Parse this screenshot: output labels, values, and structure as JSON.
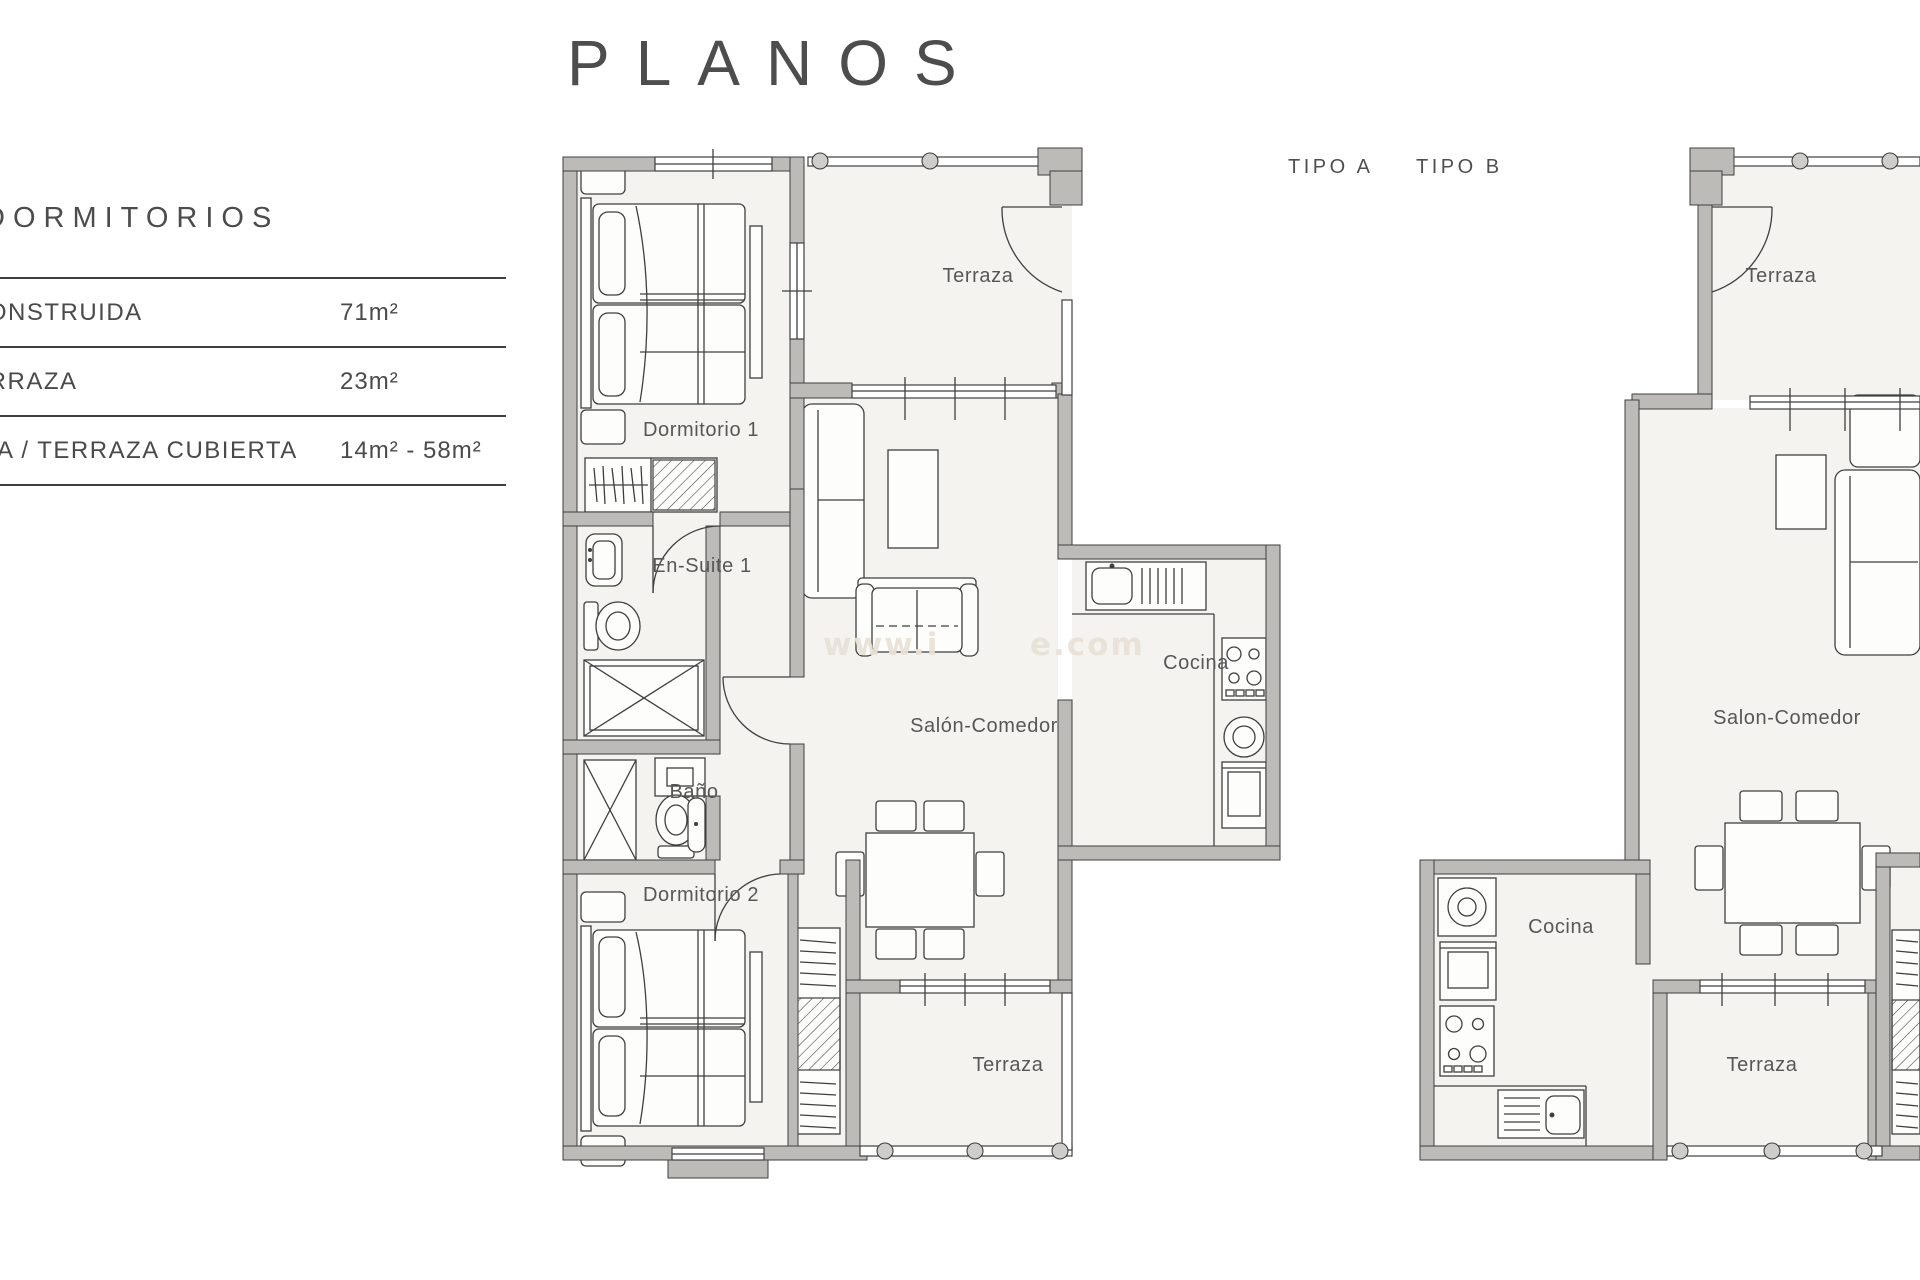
{
  "title": "PLANOS",
  "sidebar": {
    "heading": "DORMITORIOS",
    "rows": [
      {
        "label": "CONSTRUIDA",
        "value": "71m²"
      },
      {
        "label": "TERRAZA",
        "value": "23m²"
      },
      {
        "label": "A / TERRAZA CUBIERTA",
        "value": "14m² - 58m²"
      }
    ]
  },
  "plan_types": {
    "a": "TIPO A",
    "b": "TIPO B"
  },
  "plan_a": {
    "rooms": {
      "terraza_top": "Terraza",
      "dormitorio1": "Dormitorio 1",
      "ensuite": "En-Suite 1",
      "bano": "Baño",
      "dormitorio2": "Dormitorio 2",
      "salon": "Salón-Comedor",
      "cocina": "Cocina",
      "terraza_bottom": "Terraza"
    }
  },
  "plan_b": {
    "rooms": {
      "terraza_top": "Terraza",
      "salon": "Salon-Comedor",
      "cocina": "Cocina",
      "terraza_bottom": "Terraza"
    }
  },
  "watermark": {
    "prefix": "www.i",
    "suffix": "e.com"
  },
  "colors": {
    "wall": "#bdbbb7",
    "line": "#3f3f3f",
    "floor": "#f4f3f0",
    "text": "#4a4a4a",
    "watermark": "#e9e2d7"
  }
}
